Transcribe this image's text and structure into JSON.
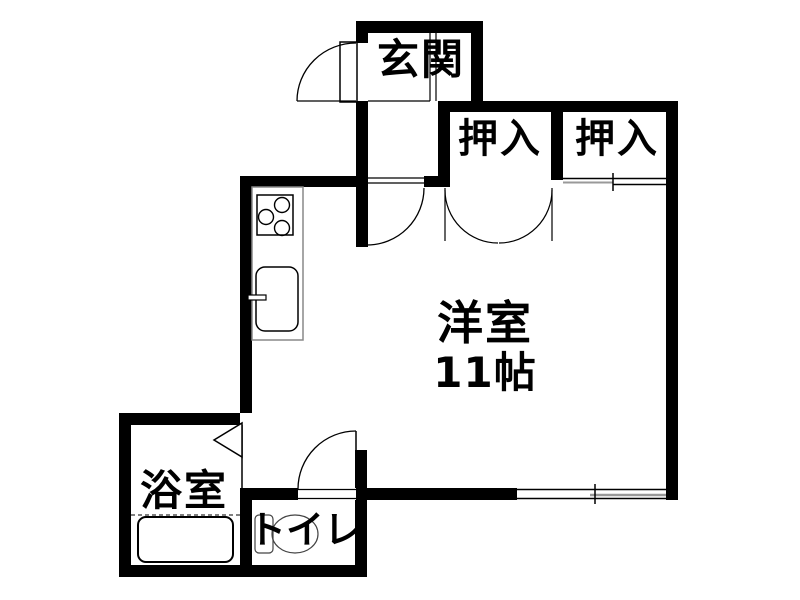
{
  "rooms": {
    "genkan": {
      "label": "玄関"
    },
    "closet_left": {
      "label": "押入"
    },
    "closet_right": {
      "label": "押入"
    },
    "main_room": {
      "label": "洋室",
      "size": "11帖"
    },
    "bathroom": {
      "label": "浴室"
    },
    "toilet": {
      "label": "トイレ"
    }
  },
  "colors": {
    "wall": "#000000",
    "background": "#ffffff",
    "counter_edge": "#888888",
    "sliding_pane_gray": "#999999",
    "fixture_line": "#444444"
  }
}
